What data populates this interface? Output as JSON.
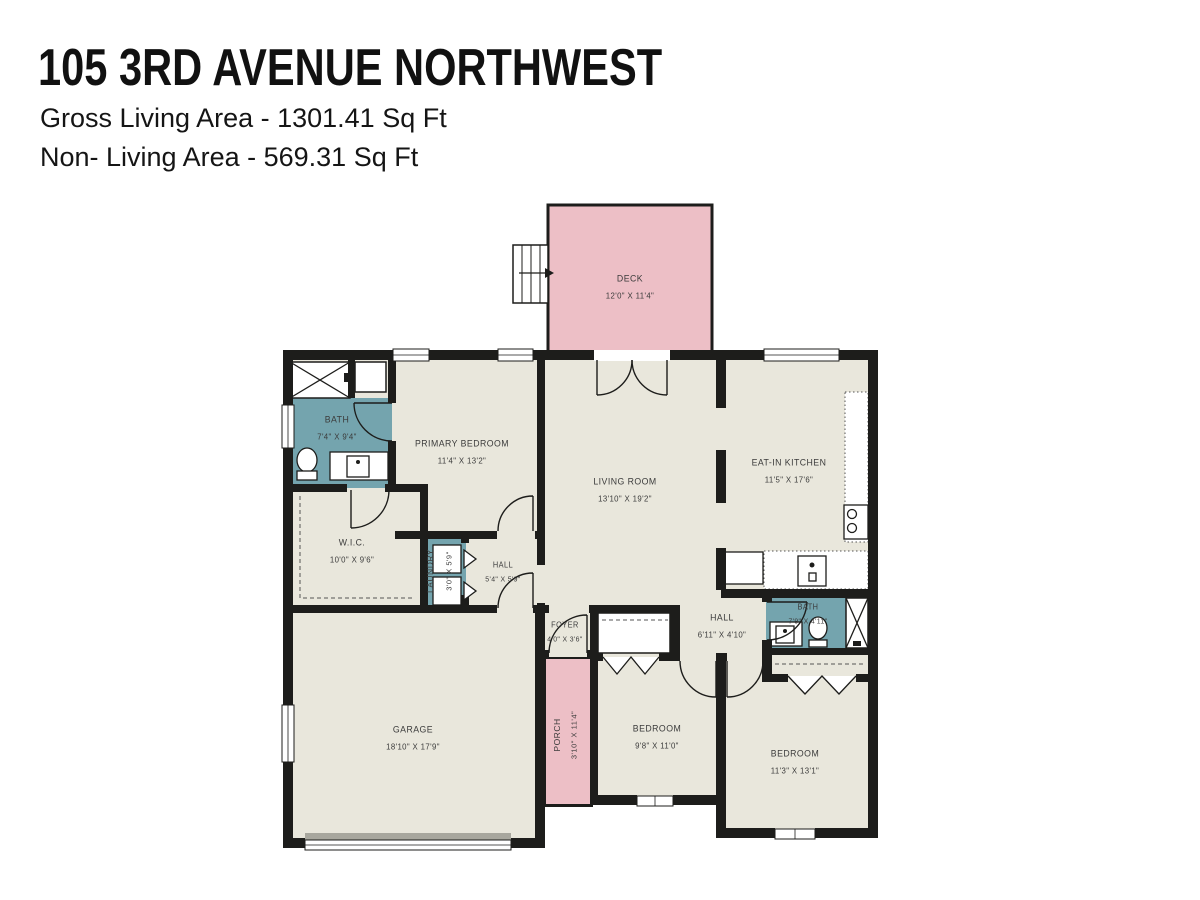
{
  "header": {
    "title": "105 3RD AVENUE NORTHWEST",
    "gross_living": "Gross Living Area - 1301.41 Sq Ft",
    "non_living": "Non- Living Area - 569.31 Sq Ft"
  },
  "colors": {
    "walls": "#1d1d1b",
    "floor": "#e9e7dc",
    "wet_rooms": "#74a4ae",
    "outdoor": "#edbfc6",
    "background": "#ffffff",
    "label_text": "#3b3b3b"
  },
  "rooms": [
    {
      "id": "deck",
      "name": "DECK",
      "dims": "12'0\" X 11'4\""
    },
    {
      "id": "bath-main",
      "name": "BATH",
      "dims": "7'4\" X 9'4\""
    },
    {
      "id": "primary-bedroom",
      "name": "PRIMARY BEDROOM",
      "dims": "11'4\" X 13'2\""
    },
    {
      "id": "living-room",
      "name": "LIVING ROOM",
      "dims": "13'10\" X 19'2\""
    },
    {
      "id": "eat-in-kitchen",
      "name": "EAT-IN KITCHEN",
      "dims": "11'5\" X 17'6\""
    },
    {
      "id": "wic",
      "name": "W.I.C.",
      "dims": "10'0\" X 9'6\""
    },
    {
      "id": "laundry",
      "name": "LAUNDRY",
      "dims": "3'0\" X 5'9\""
    },
    {
      "id": "hall",
      "name": "HALL",
      "dims": "5'4\" X 5'9\""
    },
    {
      "id": "foyer",
      "name": "FOYER",
      "dims": "4'0\" X 3'6\""
    },
    {
      "id": "hall-2",
      "name": "HALL",
      "dims": "6'11\" X 4'10\""
    },
    {
      "id": "bath-2",
      "name": "BATH",
      "dims": "7'9\" X 4'11\""
    },
    {
      "id": "garage",
      "name": "GARAGE",
      "dims": "18'10\" X 17'9\""
    },
    {
      "id": "porch",
      "name": "PORCH",
      "dims": "3'10\" X 11'4\""
    },
    {
      "id": "bedroom-1",
      "name": "BEDROOM",
      "dims": "9'8\" X 11'0\""
    },
    {
      "id": "bedroom-2",
      "name": "BEDROOM",
      "dims": "11'3\" X 13'1\""
    }
  ]
}
